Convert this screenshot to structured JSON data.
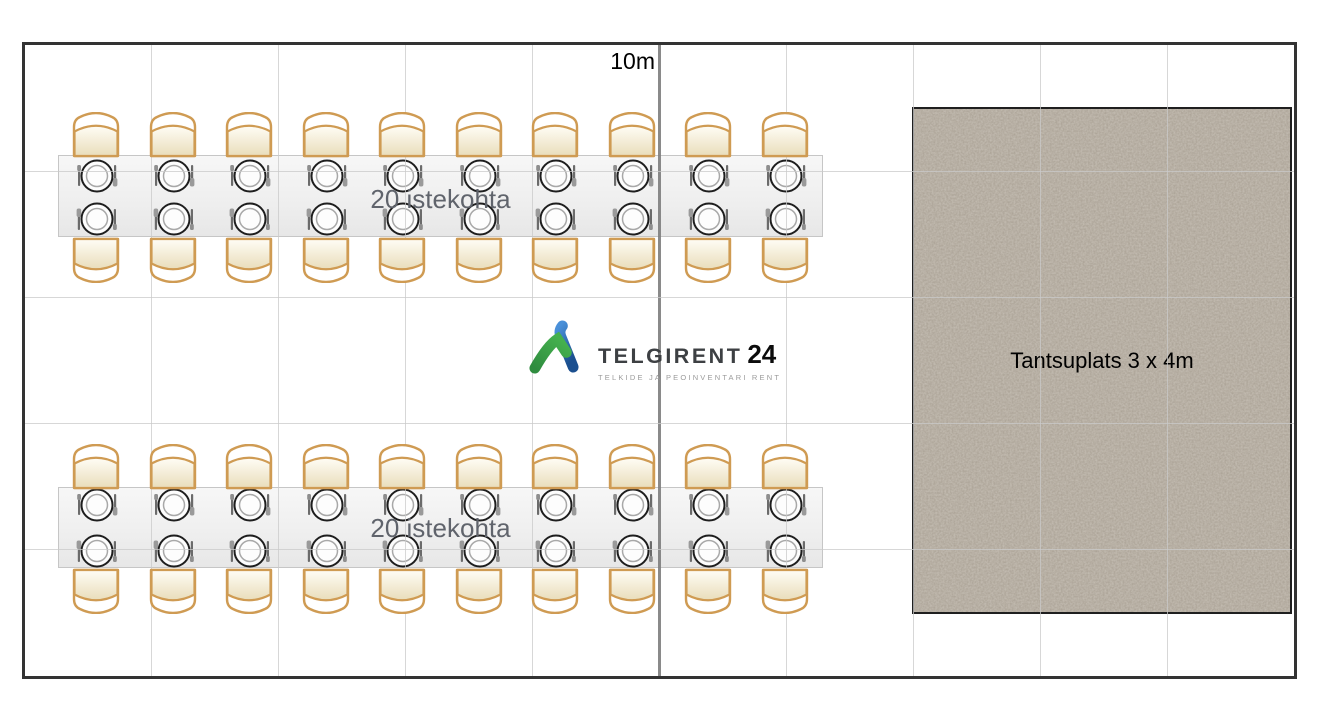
{
  "plan": {
    "width_label": "10m",
    "grid": {
      "cols": 10,
      "rows": 5
    },
    "tables": [
      {
        "id": "table-1",
        "label": "20 istekohta",
        "seats": 20,
        "seats_per_side": 10
      },
      {
        "id": "table-2",
        "label": "20 istekohta",
        "seats": 20,
        "seats_per_side": 10
      }
    ],
    "dance_floor": {
      "label": "Tantsuplats 3 x 4m"
    },
    "logo": {
      "brand": "TELGIRENT",
      "brand_number": "24",
      "tagline": "TELKIDE JA PEOINVENTARI RENT"
    },
    "colors": {
      "border": "#333333",
      "grid_line": "#c9c9c9",
      "grid_midline": "#7d7d7d",
      "chair_outline": "#cf9b53",
      "chair_fill_top": "#fffdf6",
      "chair_fill_bottom": "#e9ddba",
      "dance_floor_base": "#a39a8d",
      "text_gray": "#60646c",
      "logo_green_light": "#45b14e",
      "logo_green_dark": "#2f8c3f",
      "logo_blue_light": "#4a90d9",
      "logo_blue_dark": "#1b4f8f"
    }
  }
}
